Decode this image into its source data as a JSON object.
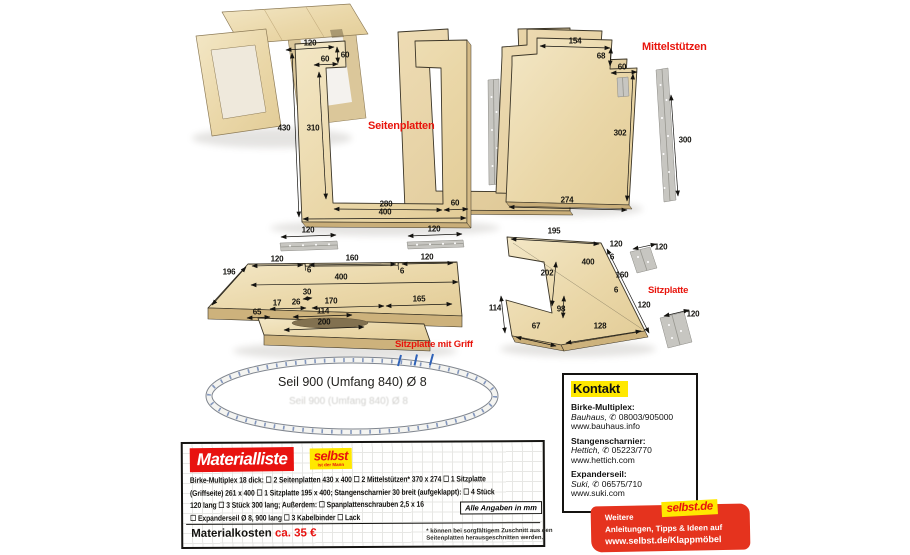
{
  "colors": {
    "accent_red": "#e8140c",
    "brand_yellow": "#ffe800",
    "banner_red": "#e5331e",
    "wood_light": "#f3e7c6",
    "wood_dark": "#ddc693",
    "hinge_gray": "#c7c6c1"
  },
  "labels": {
    "seitenplatten": "Seitenplatten",
    "mittelstuetzen": "Mittelstützen",
    "sitzplatte_griff": "Sitzplatte mit Griff",
    "sitzplatte": "Sitzplatte"
  },
  "seil": {
    "label": "Seil 900 (Umfang 840)  Ø 8"
  },
  "dims": {
    "seitenplatten": [
      {
        "t": "120",
        "x": 310,
        "y": 43
      },
      {
        "t": "60",
        "x": 345,
        "y": 55
      },
      {
        "t": "60",
        "x": 325,
        "y": 59
      },
      {
        "t": "430",
        "x": 284,
        "y": 128
      },
      {
        "t": "310",
        "x": 313,
        "y": 128
      },
      {
        "t": "280",
        "x": 386,
        "y": 204
      },
      {
        "t": "60",
        "x": 455,
        "y": 203
      },
      {
        "t": "400",
        "x": 385,
        "y": 212
      },
      {
        "t": "120",
        "x": 308,
        "y": 230
      },
      {
        "t": "120",
        "x": 434,
        "y": 229
      }
    ],
    "mittelstuetzen": [
      {
        "t": "154",
        "x": 575,
        "y": 41
      },
      {
        "t": "68",
        "x": 601,
        "y": 56
      },
      {
        "t": "60",
        "x": 622,
        "y": 67
      },
      {
        "t": "302",
        "x": 620,
        "y": 133
      },
      {
        "t": "274",
        "x": 567,
        "y": 200
      },
      {
        "t": "300",
        "x": 685,
        "y": 140
      }
    ],
    "sitzplatte_griff": [
      {
        "t": "120",
        "x": 277,
        "y": 259
      },
      {
        "t": "6",
        "x": 309,
        "y": 270
      },
      {
        "t": "160",
        "x": 352,
        "y": 258
      },
      {
        "t": "6",
        "x": 402,
        "y": 271
      },
      {
        "t": "120",
        "x": 427,
        "y": 257
      },
      {
        "t": "400",
        "x": 341,
        "y": 277
      },
      {
        "t": "196",
        "x": 229,
        "y": 272
      },
      {
        "t": "30",
        "x": 307,
        "y": 292
      },
      {
        "t": "17",
        "x": 277,
        "y": 303
      },
      {
        "t": "26",
        "x": 296,
        "y": 302
      },
      {
        "t": "170",
        "x": 331,
        "y": 301
      },
      {
        "t": "165",
        "x": 419,
        "y": 299
      },
      {
        "t": "114",
        "x": 323,
        "y": 311
      },
      {
        "t": "65",
        "x": 257,
        "y": 312
      },
      {
        "t": "200",
        "x": 324,
        "y": 322
      }
    ],
    "sitzplatte": [
      {
        "t": "195",
        "x": 554,
        "y": 231
      },
      {
        "t": "120",
        "x": 616,
        "y": 244
      },
      {
        "t": "6",
        "x": 612,
        "y": 257
      },
      {
        "t": "400",
        "x": 588,
        "y": 262
      },
      {
        "t": "202",
        "x": 547,
        "y": 273
      },
      {
        "t": "160",
        "x": 622,
        "y": 275
      },
      {
        "t": "6",
        "x": 616,
        "y": 290
      },
      {
        "t": "120",
        "x": 644,
        "y": 305
      },
      {
        "t": "114",
        "x": 495,
        "y": 308
      },
      {
        "t": "98",
        "x": 561,
        "y": 309
      },
      {
        "t": "67",
        "x": 536,
        "y": 326
      },
      {
        "t": "128",
        "x": 600,
        "y": 326
      },
      {
        "t": "120",
        "x": 661,
        "y": 247
      },
      {
        "t": "120",
        "x": 693,
        "y": 314
      }
    ]
  },
  "materialliste": {
    "title": "Materialliste",
    "logo": {
      "line1": "selbst",
      "line2": "ist der Mann"
    },
    "lines": [
      "Birke-Multiplex 18 dick: ☐ 2 Seitenplatten 430 x 400  ☐ 2 Mittelstützen* 370 x 274  ☐ 1 Sitzplatte",
      "(Griffseite) 261 x 400  ☐ 1 Sitzplatte 195 x 400;  Stangenscharnier 30 breit (aufgeklappt): ☐ 4 Stück",
      "120 lang  ☐ 3 Stück 300 lang;  Außerdem: ☐ Spanplattenschrauben 2,5 x 16",
      "☐ Expanderseil Ø 8, 900 lang  ☐ 3 Kabelbinder  ☐ Lack"
    ],
    "badge": "Alle Angaben in mm",
    "cost_label": "Materialkosten",
    "cost_value": "ca. 35 €",
    "footnote1": "* können bei sorgfältigem Zuschnitt aus den",
    "footnote2": "Seitenplatten herausgeschnitten werden."
  },
  "kontakt": {
    "title": "Kontakt",
    "sections": [
      {
        "heading": "Birke-Multiplex:",
        "vendor": "Bauhaus,",
        "phone": "✆ 08003/905000",
        "web": "www.bauhaus.info"
      },
      {
        "heading": "Stangenscharnier:",
        "vendor": "Hettich,",
        "phone": "✆ 05223/770",
        "web": "www.hettich.com"
      },
      {
        "heading": "Expanderseil:",
        "vendor": "Suki,",
        "phone": "✆ 06575/710",
        "web": "www.suki.com"
      }
    ]
  },
  "banner": {
    "logo": "selbst.de",
    "line1": "Weitere",
    "line2": "Anleitungen, Tipps & Ideen auf",
    "line3": "www.selbst.de/Klappmöbel"
  }
}
